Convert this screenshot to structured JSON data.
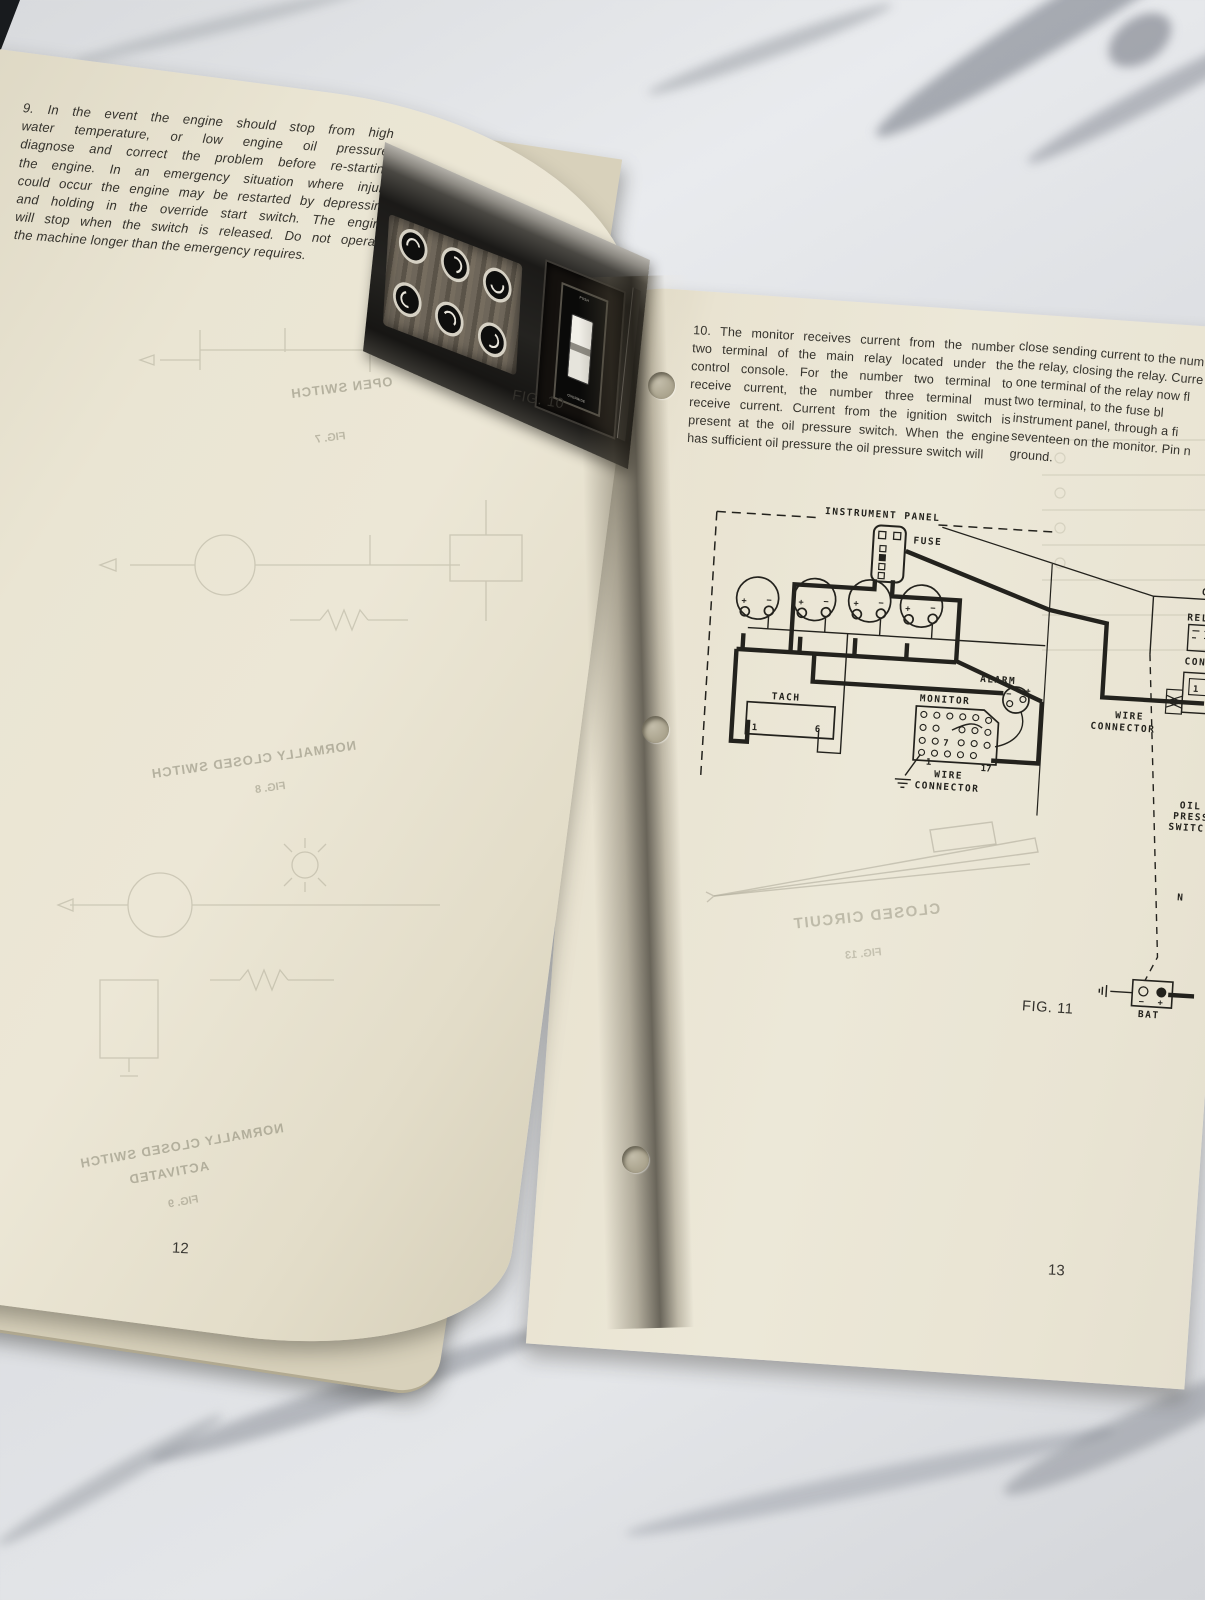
{
  "left_page": {
    "para9_lines": [
      "9. In the event the engine should stop from high",
      "water temperature, or low engine oil pressure,",
      "diagnose and correct the problem before re-starting",
      "the engine. In an emergency situation where injury",
      "could occur the engine may be restarted by depressing",
      "and holding in the override start switch. The engine",
      "will stop when the switch is released. Do not operate",
      "the machine longer than the emergency requires."
    ],
    "fig10_caption": "FIG. 10",
    "switch_push": "PUSH",
    "switch_override": "OVERRIDE",
    "page_number": "12",
    "showthrough": {
      "open_switch": "OPEN SWITCH",
      "fig7": "FIG. 7",
      "nc_switch": "NORMALLY CLOSED SWITCH",
      "fig8": "FIG. 8",
      "nc_switch2": "NORMALLY CLOSED SWITCH",
      "activated": "ACTIVATED",
      "fig9": "FIG. 9"
    }
  },
  "right_page": {
    "para10_col1_lines": [
      "10. The monitor receives current from the number",
      "two terminal of the main relay located under the",
      "control console. For the number two terminal to",
      "receive current, the number three terminal must",
      "receive current. Current from the ignition switch is",
      "present at the oil pressure switch. When the engine",
      "has sufficient oil pressure the oil pressure switch will"
    ],
    "para10_col2_lines": [
      "close sending current to the num",
      "the relay, closing the relay. Curre",
      "one terminal of the relay now fl",
      "two terminal, to the fuse bl",
      "instrument panel, through a fi",
      "seventeen on the monitor. Pin n",
      "ground."
    ],
    "fig11_caption": "FIG. 11",
    "page_number": "13",
    "diagram": {
      "instrument_panel": "INSTRUMENT PANEL",
      "fuse": "FUSE",
      "tach": "TACH",
      "tach_pin_1": "1",
      "tach_pin_6": "6",
      "monitor": "MONITOR",
      "monitor_pin_7": "7",
      "monitor_pin_17": "17",
      "monitor_pin_1": "1",
      "wire_connector_monitor_l1": "WIRE",
      "wire_connector_monitor_l2": "CONNECTOR",
      "alarm": "ALARM",
      "wire_connector_right_l1": "WIRE",
      "wire_connector_right_l2": "CONNECTOR",
      "console_partial": "CO",
      "relay_partial": "RELA",
      "connector_partial": "CON",
      "box_pin_1": "1",
      "oil_l1": "OIL",
      "oil_l2": "PRESS",
      "oil_l3": "SWITC",
      "n_label": "N",
      "bat": "BAT",
      "plus": "+",
      "minus": "−"
    },
    "showthrough": {
      "closed_circuit": "CLOSED CIRCUIT",
      "fig13": "FIG. 13"
    }
  }
}
